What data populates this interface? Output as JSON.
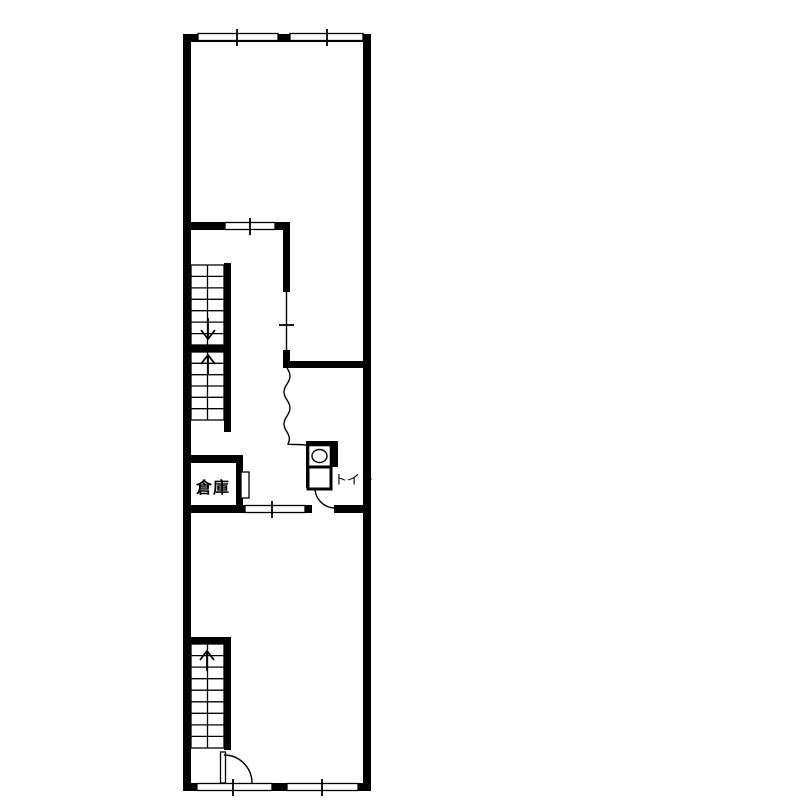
{
  "floorplan": {
    "labels": {
      "storage": "倉庫",
      "toilet": "トイレ"
    },
    "colors": {
      "line": "#000000",
      "background": "#ffffff"
    }
  }
}
